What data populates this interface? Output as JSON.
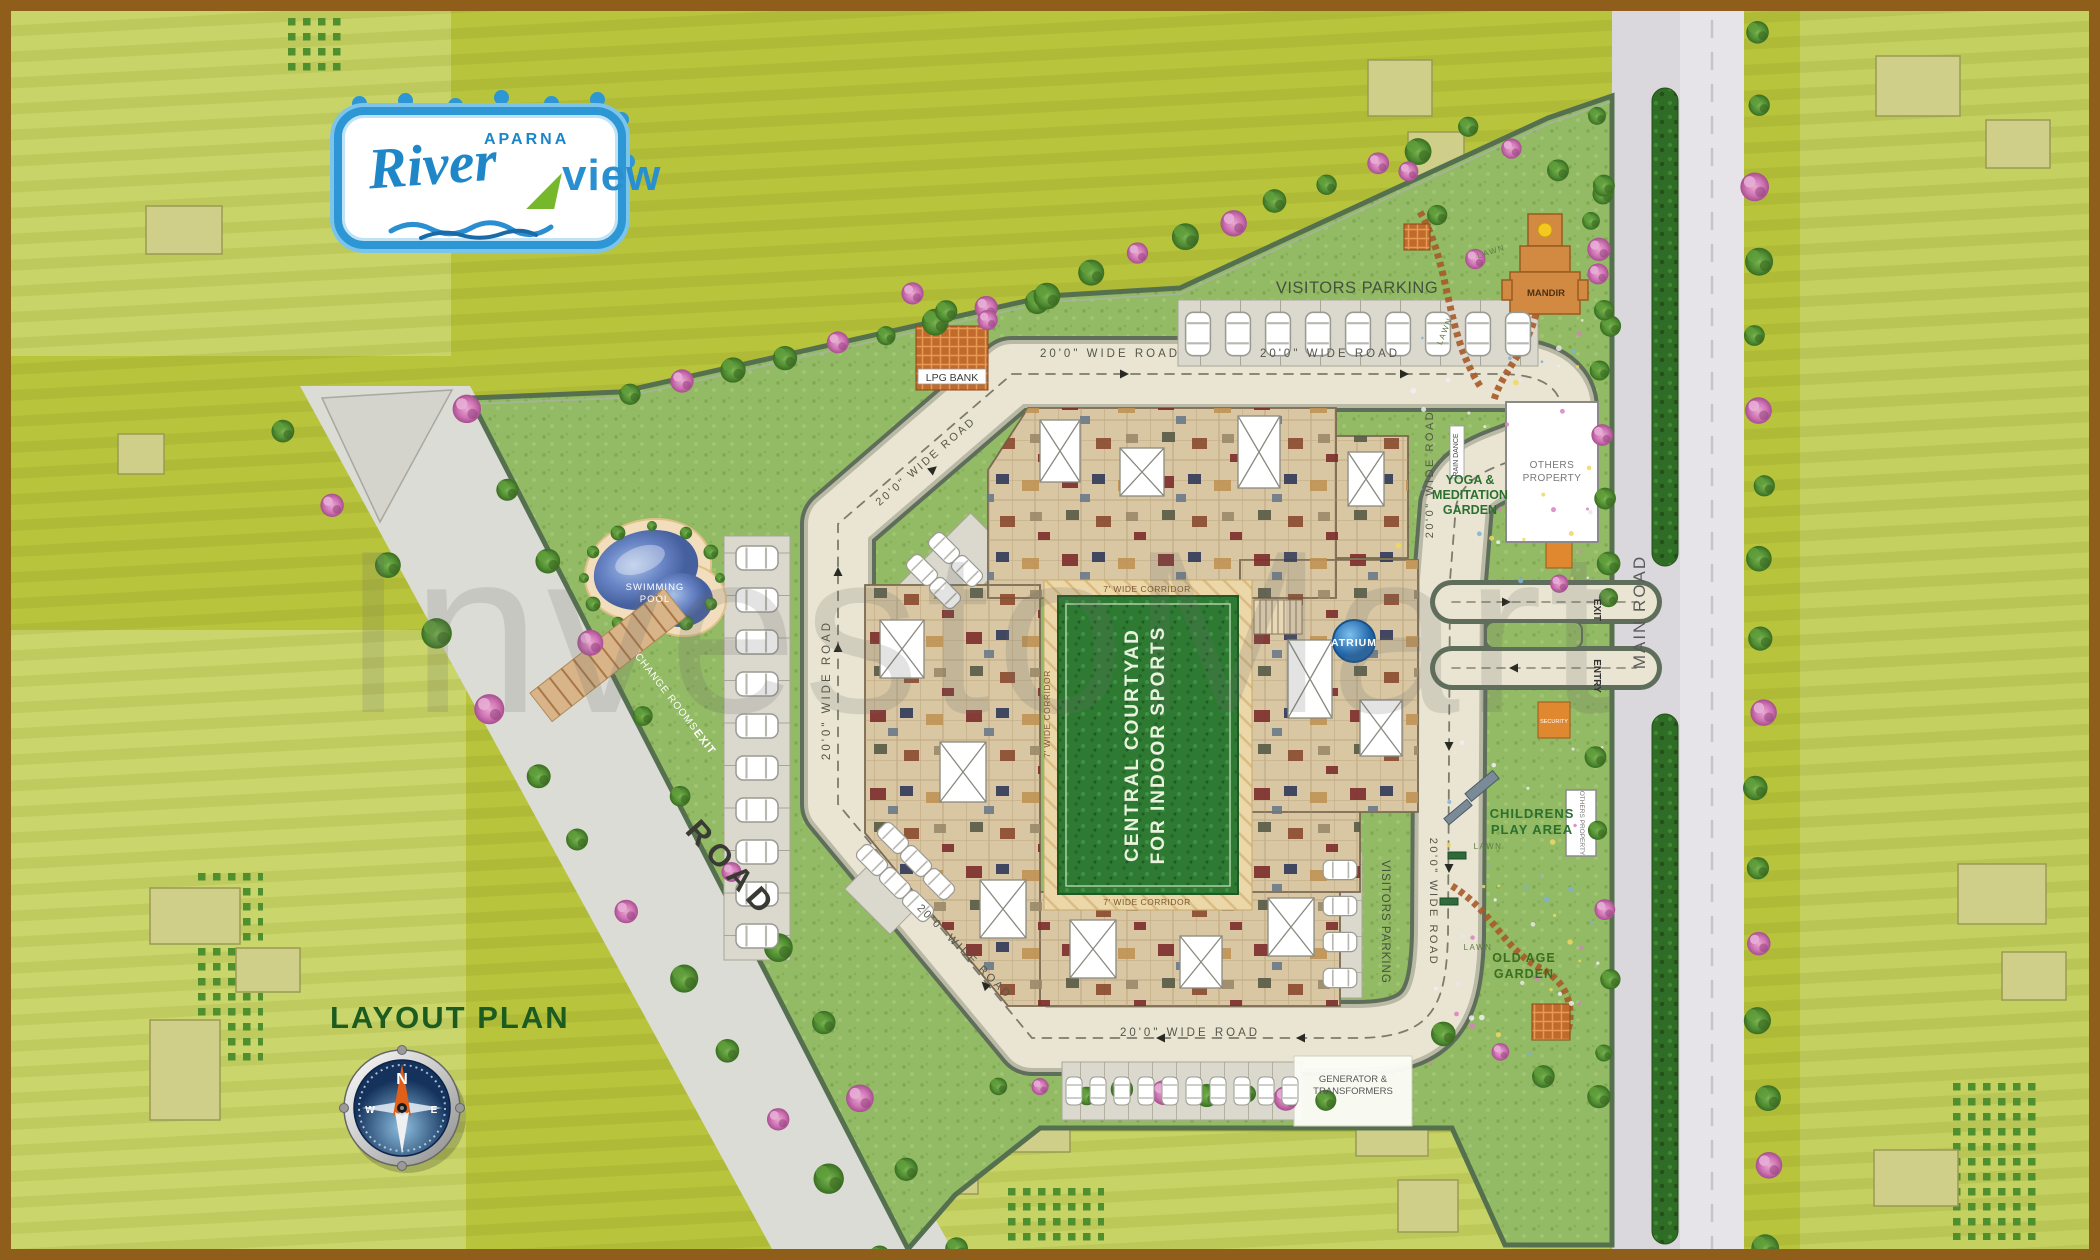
{
  "logo": {
    "aparna": "APARNA",
    "river": "River",
    "view": "view"
  },
  "plan": {
    "title": "LAYOUT PLAN"
  },
  "compass": {
    "n": "N",
    "w": "W",
    "e": "E"
  },
  "watermark": {
    "text": "InvestoMart"
  },
  "roads": {
    "wide_road": "20'0\" WIDE ROAD",
    "main_road": "MAIN ROAD",
    "road": "ROAD",
    "corridor": "7' WIDE CORRIDOR"
  },
  "areas": {
    "visitors_parking": "VISITORS PARKING",
    "lpg_bank": "LPG BANK",
    "swimming_pool_lines": [
      "SWIMMING",
      "POOL"
    ],
    "change_rooms": "CHANGE ROOMS",
    "exit": "EXIT",
    "entry": "ENTRY",
    "security": "SECURITY",
    "mandir": "MANDIR",
    "rain_dance": "RAIN DANCE",
    "yoga_lines": [
      "YOGA &",
      "MEDITATION",
      "GARDEN"
    ],
    "others_property": "OTHERS PROPERTY",
    "others_property_lines": [
      "OTHERS",
      "PROPERTY"
    ],
    "children_lines": [
      "CHILDRENS",
      "PLAY AREA"
    ],
    "old_age_lines": [
      "OLD AGE",
      "GARDEN"
    ],
    "generator_lines": [
      "GENERATOR &",
      "TRANSFORMERS"
    ],
    "atrium": "ATRIUM",
    "courtyard_lines": [
      "CENTRAL COURTYAD",
      "FOR INDOOR SPORTS"
    ],
    "lawn": "LAWN"
  },
  "colors": {
    "brand_blue": "#2a8fd0",
    "leaf_green": "#76b82c",
    "field_olive": "#b8c43c",
    "site_green": "#93ba64",
    "road_cream": "#e9e5d2",
    "main_road_gray": "#dad8dc",
    "courtyard_green": "#2e7a33",
    "pool_blue": "#5b7fc4",
    "mandir_orange": "#d28a42",
    "title_green": "#1d5c20",
    "label_green": "#2c7030"
  }
}
